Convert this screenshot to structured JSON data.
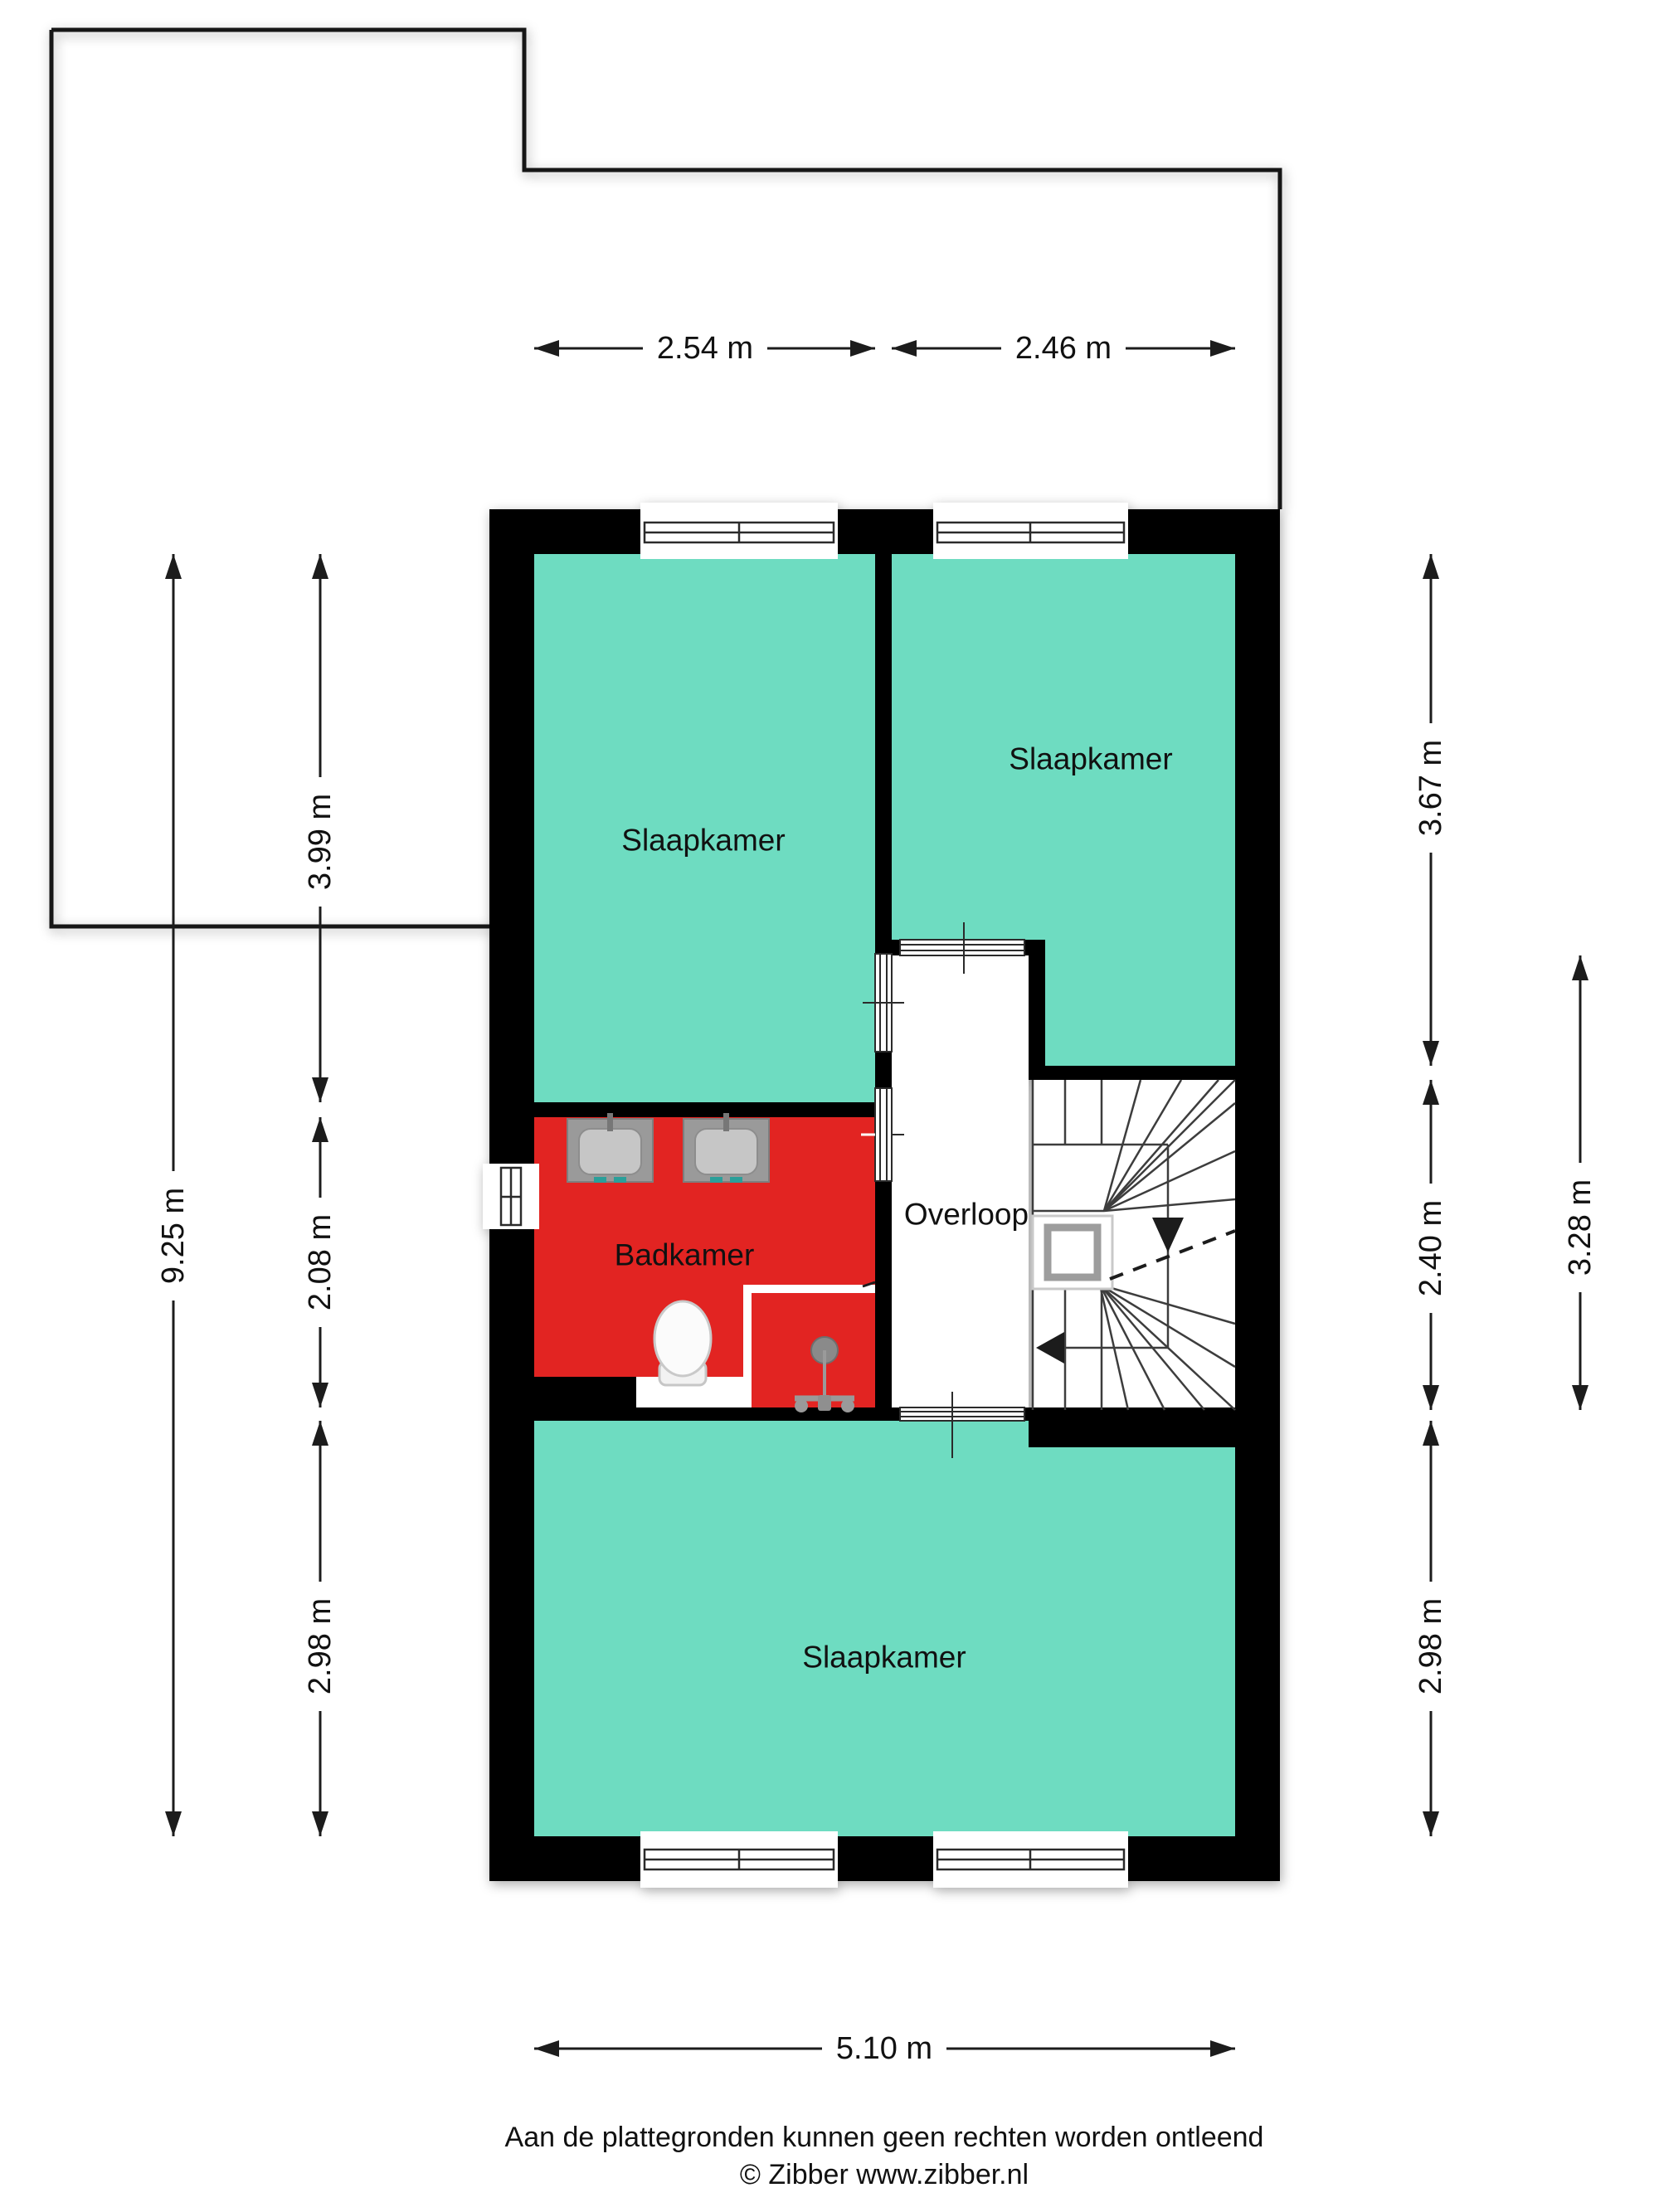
{
  "meta": {
    "type": "floorplan-first-floor"
  },
  "colors": {
    "room_green": "#6edcc1",
    "bathroom_red": "#e22422",
    "wall_black": "#000000",
    "fixture_gray": "#9a9a9a"
  },
  "rooms": [
    {
      "id": "slaapkamer-top-left",
      "label": "Slaapkamer"
    },
    {
      "id": "slaapkamer-top-right",
      "label": "Slaapkamer"
    },
    {
      "id": "badkamer",
      "label": "Badkamer"
    },
    {
      "id": "overloop",
      "label": "Overloop"
    },
    {
      "id": "slaapkamer-bottom",
      "label": "Slaapkamer"
    }
  ],
  "dimensions": {
    "top": [
      {
        "label": "2.54 m"
      },
      {
        "label": "2.46 m"
      }
    ],
    "left_outer": {
      "label": "9.25 m"
    },
    "left_inner": [
      {
        "label": "3.99 m"
      },
      {
        "label": "2.08 m"
      },
      {
        "label": "2.98 m"
      }
    ],
    "right_inner": [
      {
        "label": "3.67 m"
      },
      {
        "label": "2.40 m"
      },
      {
        "label": "2.98 m"
      }
    ],
    "right_outer": {
      "label": "3.28 m"
    },
    "bottom": {
      "label": "5.10 m"
    }
  },
  "fixtures": [
    {
      "name": "sink"
    },
    {
      "name": "sink"
    },
    {
      "name": "toilet"
    },
    {
      "name": "shower"
    },
    {
      "name": "staircase"
    }
  ],
  "footer": {
    "disclaimer": "Aan de plattegronden kunnen geen rechten worden ontleend",
    "credit": "© Zibber www.zibber.nl"
  }
}
